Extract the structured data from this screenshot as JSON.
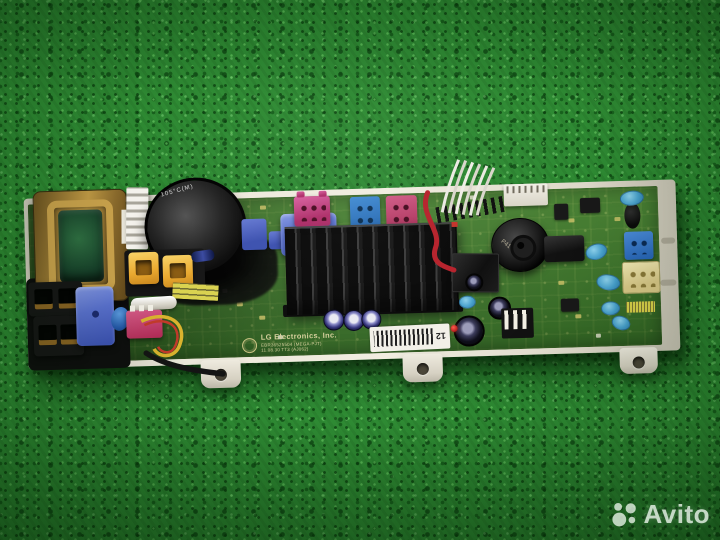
{
  "scene": {
    "subject": "LG Electronics washing machine control board (PCB) photographed on green fabric",
    "background_color": "#2e8a33"
  },
  "watermark": {
    "text": "Avito",
    "logo": "avito-dots-logo",
    "color": "#ffffff"
  },
  "pcb": {
    "silkscreen": {
      "line1": "LG Electronics, Inc.",
      "line2": "EBR36525504 (MEGA-PJT)",
      "line3": "11.08.30 TT3 (AJ062)"
    },
    "markings": {
      "buzzer": "P41",
      "capacitor": "105°C(M)",
      "barcode_label": "12"
    },
    "components": [
      "transformer",
      "large electrolytic capacitor",
      "finned black heatsink",
      "piezo buzzer",
      "microcontroller IC",
      "blue relays",
      "pink wire-harness connectors",
      "blue wire-harness connectors",
      "yellow connectors",
      "white mounting tray with screw tabs",
      "wire loops (red, yellow, black, white harness)",
      "barcode label"
    ],
    "palette": {
      "board_green": "#3c782b",
      "tray_white": "#ece8db",
      "connector_pink": "#c2407c",
      "connector_blue": "#2e7ec5",
      "connector_yellow": "#f0bd45",
      "relay_blue": "#5b72d0",
      "heatsink_black": "#101010",
      "transformer_copper": "#b08f3e",
      "wire_red": "#b51e28",
      "wire_yellow": "#d9b32e"
    }
  }
}
